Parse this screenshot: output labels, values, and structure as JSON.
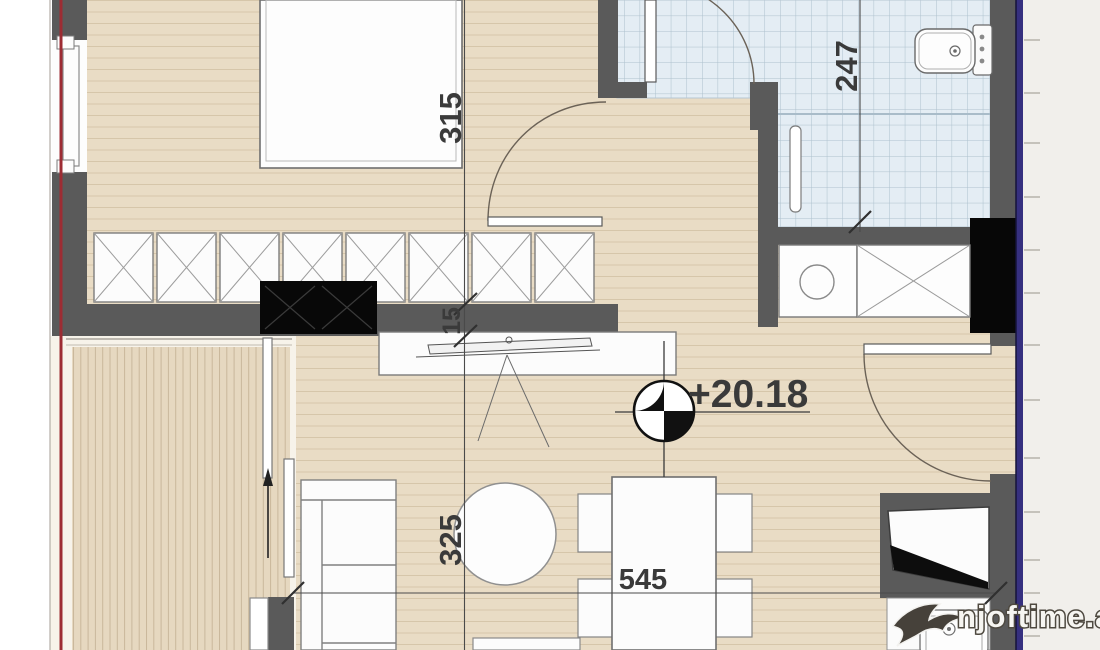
{
  "plan": {
    "dimension_labels": {
      "bedroom_depth": "315",
      "wall_thickness": "15",
      "bathroom_depth": "247",
      "living_depth": "325",
      "living_width": "545"
    },
    "level_marker": {
      "value": "+20.18",
      "symbol": "survey-level-icon"
    },
    "watermark": {
      "text": "njoftime.al",
      "logo": "swallow-icon"
    },
    "colors": {
      "wall": "#5a5a5a",
      "black_fixture": "#0a0a0a",
      "floor_wood": "#e9dcc5",
      "floor_plank_line": "#d6c6aa",
      "balcony_deck": "#e6d8c0",
      "balcony_deck_line": "#c9b79b",
      "bathroom_tile": "#e4edf4",
      "bathroom_tile_grid": "#adc0cd",
      "red_reference_line": "#9d2c33",
      "purple_border": "#36307f",
      "dimension_ink": "#3a3a3a",
      "furniture_fill": "#fcfcfc",
      "furniture_stroke": "#7a7a7a"
    }
  }
}
